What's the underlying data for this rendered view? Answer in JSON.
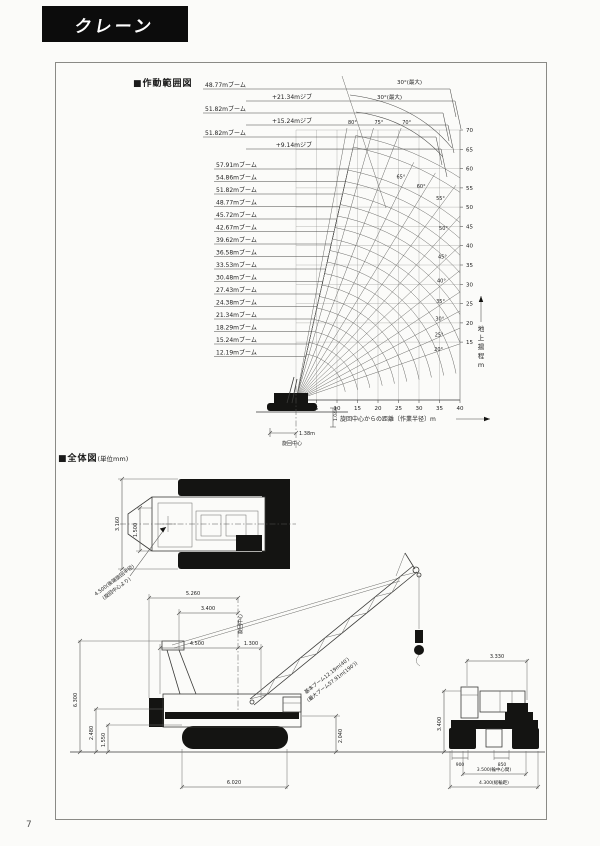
{
  "page": {
    "tab_title": "クレーン",
    "page_number": "7"
  },
  "working_range": {
    "title": "■作動範囲図",
    "jib_configs": [
      {
        "boom": "48.77mブーム",
        "jib": "+21.34mジブ"
      },
      {
        "boom": "51.82mブーム",
        "jib": "+15.24mジブ"
      },
      {
        "boom": "51.82mブーム",
        "jib": "+9.14mジブ"
      }
    ],
    "boom_labels": [
      "57.91mブーム",
      "54.86mブーム",
      "51.82mブーム",
      "48.77mブーム",
      "45.72mブーム",
      "42.67mブーム",
      "39.62mブーム",
      "36.58mブーム",
      "33.53mブーム",
      "30.48mブーム",
      "27.43mブーム",
      "24.38mブーム",
      "21.34mブーム",
      "18.29mブーム",
      "15.24mブーム",
      "12.19mブーム"
    ],
    "max_offset_labels": [
      "30°(最大)",
      "30°(最大)"
    ],
    "x_axis": {
      "label": "旋回中心からの距離〔作業半径〕m",
      "ticks": [
        "5",
        "10",
        "15",
        "20",
        "25",
        "30",
        "35",
        "40"
      ]
    },
    "y_axis": {
      "label": "地上揚程m",
      "ticks": [
        "15",
        "20",
        "25",
        "30",
        "35",
        "40",
        "45",
        "50",
        "55",
        "60",
        "65",
        "70"
      ]
    },
    "base": {
      "swing_center": "旋回中心",
      "tail_radius": "1.38m",
      "foot_height": "1.04m"
    }
  },
  "chart_data": {
    "type": "line",
    "title": "作動範囲図",
    "xlabel": "旋回中心からの距離〔作業半径〕m",
    "ylabel": "地上揚程m",
    "xlim": [
      0,
      40
    ],
    "ylim": [
      0,
      70
    ],
    "grid": true,
    "boom_lengths_m": [
      57.91,
      54.86,
      51.82,
      48.77,
      45.72,
      42.67,
      39.62,
      36.58,
      33.53,
      30.48,
      27.43,
      24.38,
      21.34,
      18.29,
      15.24,
      12.19
    ],
    "jib_combinations": [
      {
        "boom_m": 48.77,
        "jib_m": 21.34
      },
      {
        "boom_m": 51.82,
        "jib_m": 15.24
      },
      {
        "boom_m": 51.82,
        "jib_m": 9.14
      }
    ],
    "boom_angle_lines_deg": [
      20,
      25,
      30,
      35,
      40,
      45,
      50,
      55,
      60,
      65,
      70,
      75,
      80
    ],
    "angle_labels": [
      "20°",
      "25°",
      "30°",
      "35°",
      "40°",
      "45°",
      "50°",
      "55°",
      "60°",
      "65°",
      "70°",
      "75°",
      "80°"
    ],
    "max_jib_offset_deg": 30,
    "radius_ticks_m": [
      5,
      10,
      15,
      20,
      25,
      30,
      35,
      40
    ],
    "height_ticks_m": [
      15,
      20,
      25,
      30,
      35,
      40,
      45,
      50,
      55,
      60,
      65,
      70
    ]
  },
  "general_drawing": {
    "title": "■全体図",
    "unit": "(単位mm)",
    "plan_view": {
      "overall_width": "3.160",
      "body_width": "1.500",
      "tail_note_1": "4.500(後端旋回半径)",
      "tail_note_2": "(旋回中心より)"
    },
    "side_view": {
      "rear_to_center": "5.260",
      "upper_len": "3.400",
      "tail_len": "4.500",
      "front_len": "1.300",
      "gantry_height": "6.300",
      "deck_height": "2.480",
      "track_height": "1.550",
      "body_height": "2.040",
      "track_length": "6.020",
      "swing_center": "旋回中心",
      "boom_note_1": "基本ブーム12.19m(40′)",
      "boom_note_2": "(最大ブーム57.91m(190′))"
    },
    "rear_view": {
      "upper_width": "3.330",
      "cab_height": "3.400",
      "shoe_width": "900",
      "center_dim": "850",
      "track_center": "3.500(輪中心間)",
      "overall_width": "4.300(総輪距)"
    }
  }
}
